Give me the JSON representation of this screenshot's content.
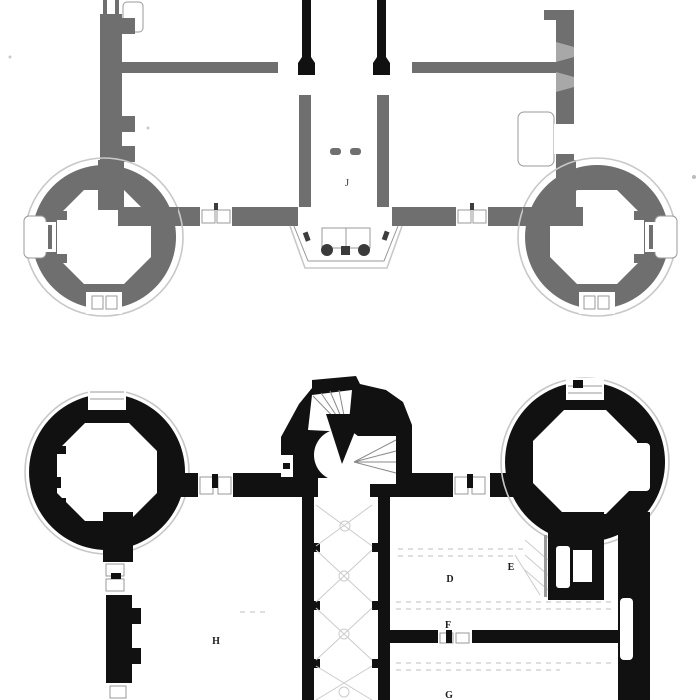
{
  "drawing": {
    "kind": "scanned architectural floor plans, two stacked château plans",
    "background": "#ffffff"
  },
  "colors": {
    "background": "#ffffff",
    "top_wall": "#6f6f6f",
    "top_splay": "#a8a8a8",
    "outline": "#c8c8c8",
    "black_wall": "#111111",
    "door_detail": "#999999",
    "hatch": "#cccccc",
    "tread": "#8a8a8a",
    "column": "#3a3a3a",
    "label_top": "#4a4a4a",
    "label_bottom": "#1b1b1b"
  },
  "plans": {
    "top": {
      "name": "upper floor plan (gray, round towers at south corners, central vestibule with porch)",
      "labels": [
        {
          "text": "J"
        }
      ]
    },
    "bottom": {
      "name": "ground floor plan (black, round towers at north corners, central spiral stair tower)",
      "labels": [
        {
          "text": "H"
        },
        {
          "text": "D"
        },
        {
          "text": "E"
        },
        {
          "text": "F"
        },
        {
          "text": "G"
        }
      ]
    }
  }
}
